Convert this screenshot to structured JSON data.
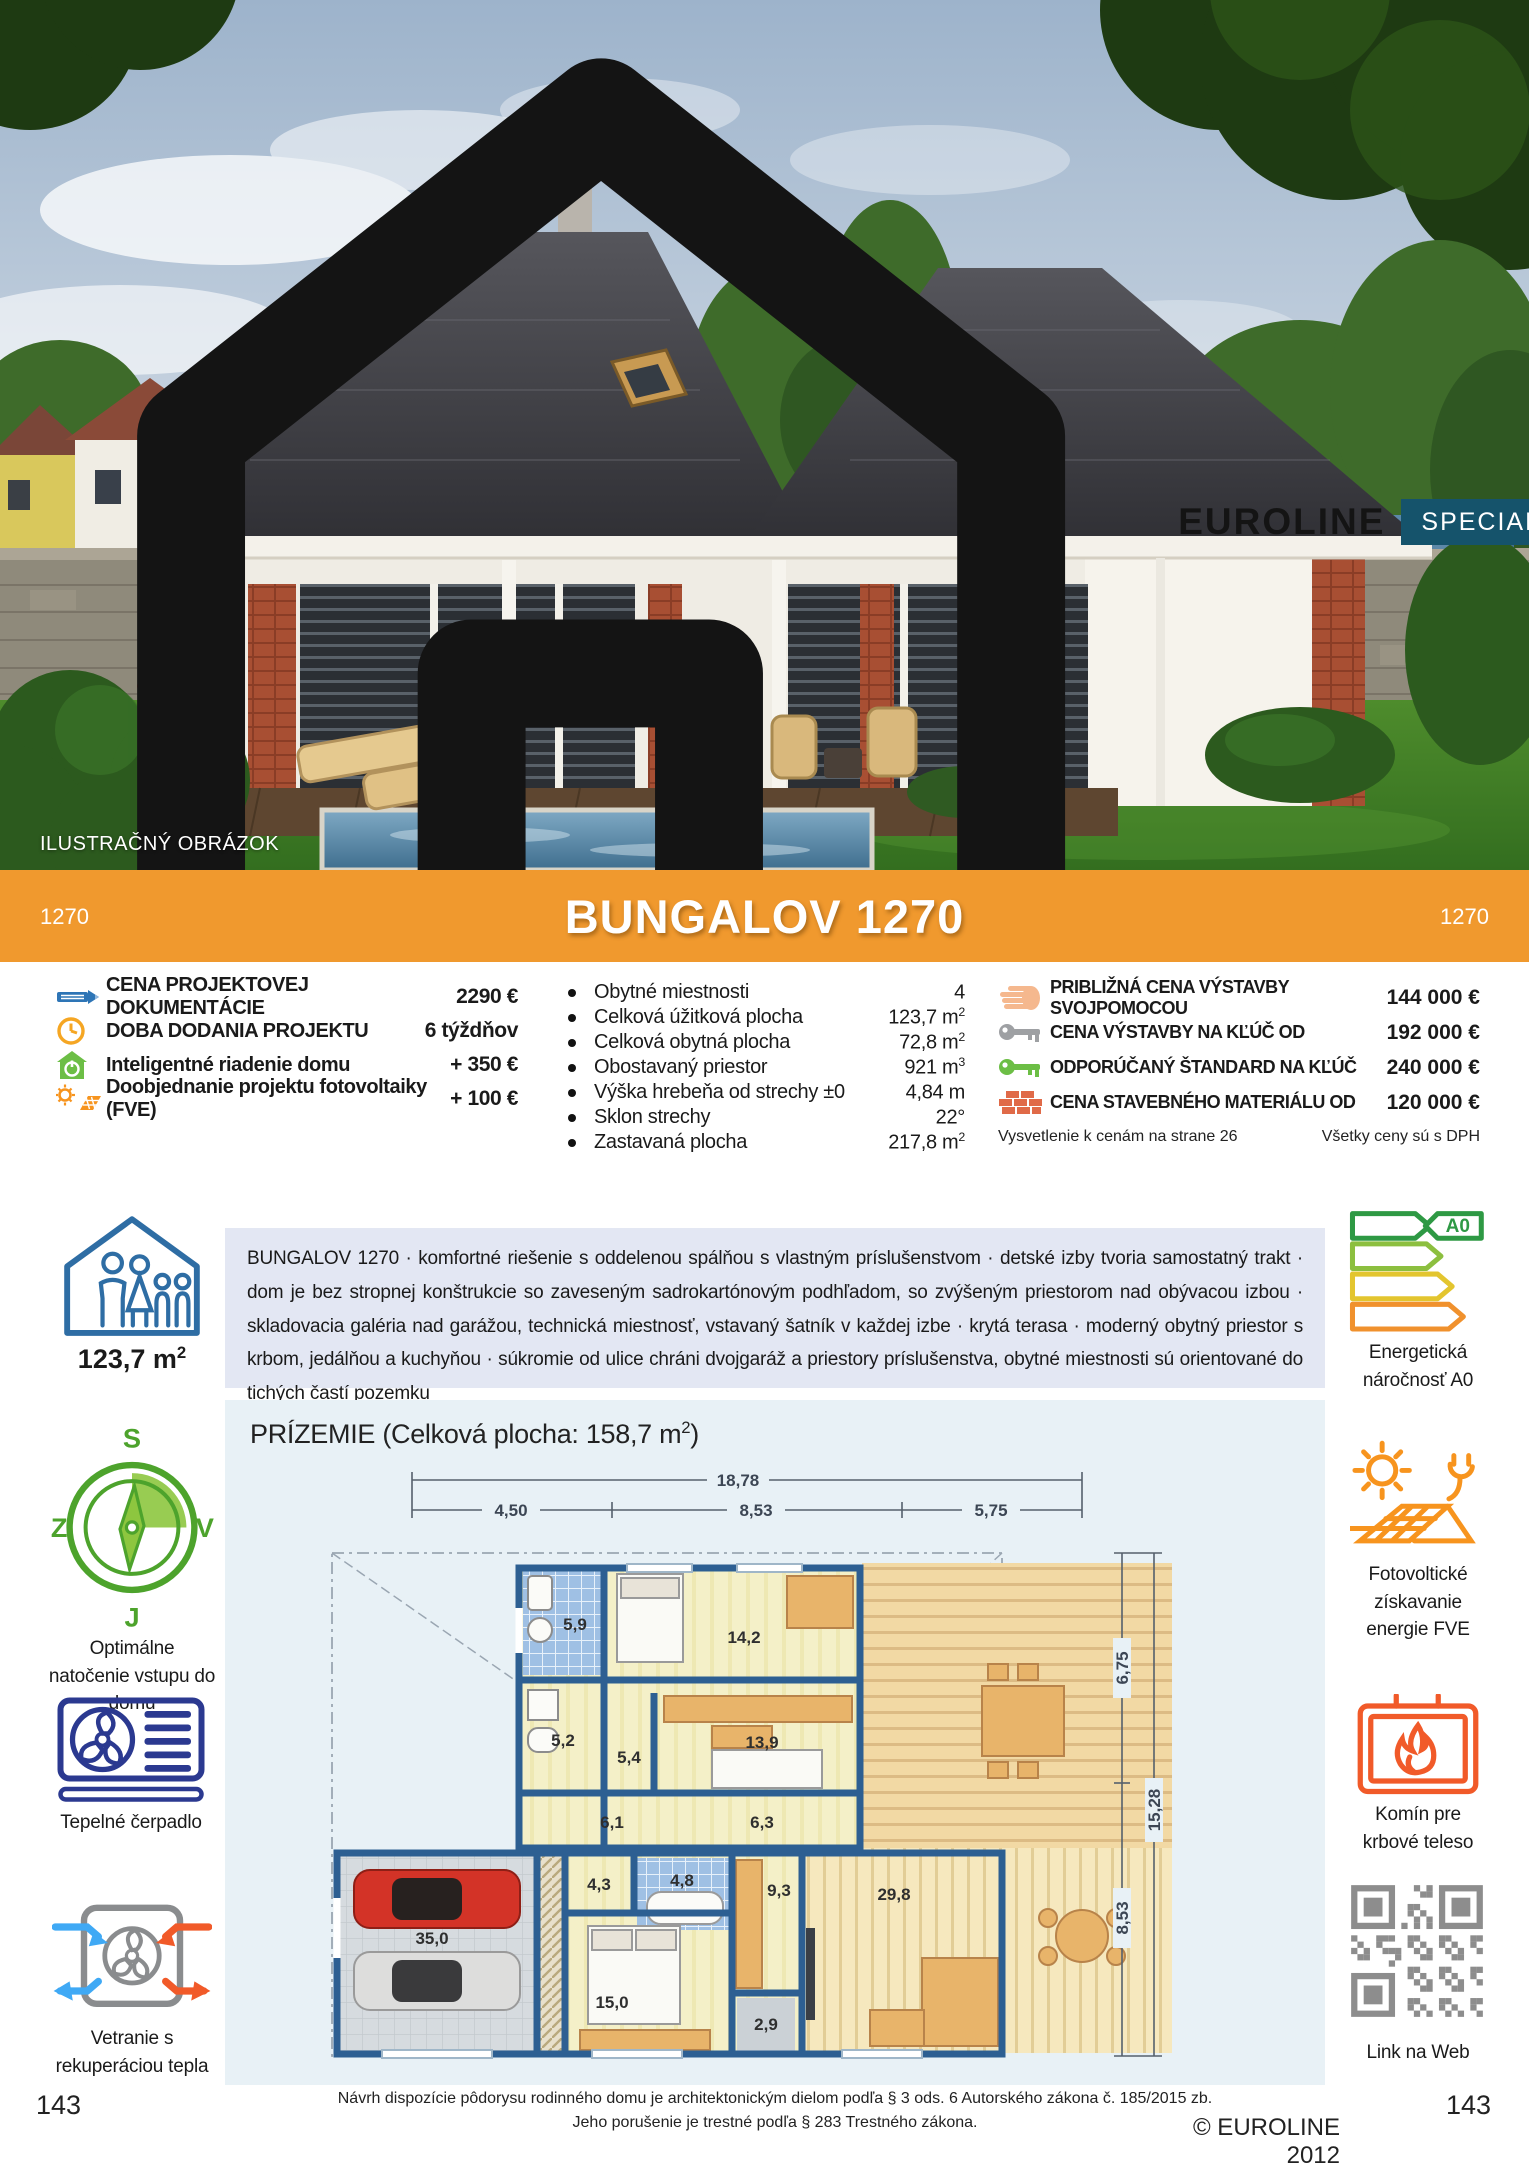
{
  "header": {
    "brand": "EUROLINE",
    "badge": "SPECIAL",
    "badge_s": "S",
    "photo_caption": "ILUSTRAČNÝ OBRÁZOK"
  },
  "banner": {
    "title": "BUNGALOV 1270",
    "code_left": "1270",
    "code_right": "1270"
  },
  "pricing_left": {
    "items": [
      {
        "label": "CENA PROJEKTOVEJ DOKUMENTÁCIE",
        "value": "2290 €"
      },
      {
        "label": "DOBA DODANIA PROJEKTU",
        "value": "6 týždňov"
      },
      {
        "label": "Inteligentné riadenie domu",
        "value": "+ 350 €"
      },
      {
        "label": "Doobjednanie projektu fotovoltaiky (FVE)",
        "value": "+ 100 €"
      }
    ]
  },
  "specs": {
    "items": [
      {
        "label": "Obytné miestnosti",
        "value": "4",
        "sup": ""
      },
      {
        "label": "Celková úžitková plocha",
        "value": "123,7 m",
        "sup": "2"
      },
      {
        "label": "Celková obytná plocha",
        "value": "72,8 m",
        "sup": "2"
      },
      {
        "label": "Obostavaný priestor",
        "value": "921 m",
        "sup": "3"
      },
      {
        "label": "Výška hrebeňa od strechy ±0",
        "value": "4,84 m",
        "sup": ""
      },
      {
        "label": "Sklon strechy",
        "value": "22°",
        "sup": ""
      },
      {
        "label": "Zastavaná plocha",
        "value": "217,8 m",
        "sup": "2"
      }
    ]
  },
  "pricing_right": {
    "items": [
      {
        "label": "PRIBLIŽNÁ CENA VÝSTAVBY SVOJPOMOCOU",
        "value": "144 000 €"
      },
      {
        "label": "CENA VÝSTAVBY NA KĽÚČ OD",
        "value": "192 000 €"
      },
      {
        "label": "ODPORÚČANÝ ŠTANDARD NA KĽÚČ",
        "value": "240 000 €"
      },
      {
        "label": "CENA STAVEBNÉHO MATERIÁLU OD",
        "value": "120 000 €"
      }
    ],
    "note_left": "Vysvetlenie k cenám na strane 26",
    "note_right": "Všetky ceny sú s DPH"
  },
  "description": {
    "text": "BUNGALOV 1270 · komfortné riešenie s oddelenou spálňou s vlastným príslušenstvom · detské izby tvoria samostatný trakt · dom je bez stropnej konštrukcie so zaveseným sadrokartónovým podhľadom, so zvýšeným priestorom nad obývacou izbou · skladovacia galéria nad garážou, technická miestnosť, vstavaný šatník v každej izbe · krytá terasa · moderný obytný priestor s krbom, jedálňou a kuchyňou · súkromie od ulice chráni dvojgaráž a priestory príslušenstva, obytné miestnosti sú orientované do tichých častí pozemku"
  },
  "sidebar_left": {
    "area_value": "123,7 m",
    "area_sup": "2",
    "compass": {
      "n": "S",
      "e": "V",
      "s": "J",
      "w": "Z"
    },
    "compass_label": "Optimálne natočenie vstupu do domu",
    "heatpump_label": "Tepelné čerpadlo",
    "vent_label": "Vetranie s rekuperáciou tepla"
  },
  "sidebar_right": {
    "energy_badge": "A0",
    "energy_label": "Energetická náročnosť A0",
    "pv_label": "Fotovoltické získavanie energie FVE",
    "fireplace_label": "Komín pre krbové teleso",
    "qr_label": "Link na Web"
  },
  "plan": {
    "heading_prefix": "PRÍZEMIE (Celková plocha: 158,7 m",
    "heading_sup": "2",
    "heading_suffix": ")",
    "dims": {
      "w_total": "18,78",
      "w1": "4,50",
      "w2": "8,53",
      "w3": "5,75",
      "h1": "6,75",
      "h_total": "15,28",
      "h2": "8,53"
    },
    "rooms": {
      "bath1": "5,9",
      "bed1": "14,2",
      "tech": "5,2",
      "hall": "5,4",
      "bed2": "13,9",
      "corr1": "6,1",
      "corr2": "6,3",
      "ward": "4,3",
      "bath2": "4,8",
      "kitchen": "9,3",
      "living": "29,8",
      "garage": "35,0",
      "bed3": "15,0",
      "wc": "2,9"
    }
  },
  "footer": {
    "line1": "Návrh dispozície pôdorysu rodinného domu je architektonickým dielom podľa § 3 ods. 6 Autorského zákona č. 185/2015 zb.",
    "line2": "Jeho porušenie je trestné podľa § 283 Trestného zákona.",
    "copyright": "© EUROLINE 2012",
    "page_left": "143",
    "page_right": "143"
  }
}
